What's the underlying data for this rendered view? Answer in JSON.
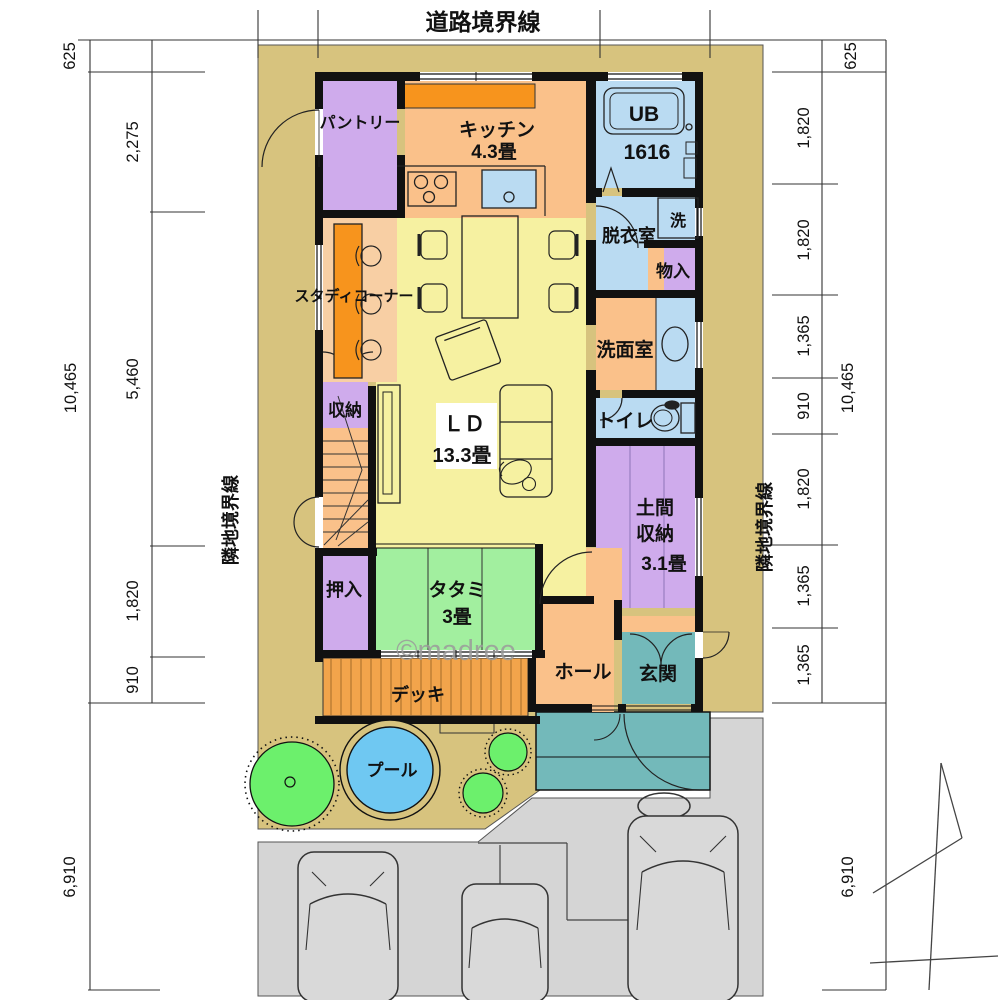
{
  "labels": {
    "road_boundary": "道路境界線",
    "neighbor_boundary_left": "隣地境界線",
    "neighbor_boundary_right": "隣地境界線",
    "watermark": "©madree"
  },
  "dims": {
    "left": {
      "outer": [
        "625",
        "10,465",
        "6,910"
      ],
      "inner": [
        "2,275",
        "5,460",
        "1,820",
        "910"
      ]
    },
    "right": {
      "outer": [
        "625",
        "10,465",
        "6,910"
      ],
      "inner": [
        "1,820",
        "1,820",
        "1,365",
        "910",
        "1,820",
        "1,365",
        "1,365"
      ]
    }
  },
  "rooms": {
    "pantry": "パントリー",
    "kitchen": "キッチン",
    "kitchen_size": "4.3畳",
    "unit_bath": "UB",
    "unit_bath_size": "1616",
    "washer": "洗",
    "dressing_room": "脱衣室",
    "closet_small": "物入",
    "washroom": "洗面室",
    "toilet": "トイレ",
    "study_corner": "スタディコーナー",
    "stair_storage": "収納",
    "living_dining": "ＬＤ",
    "living_dining_size": "13.3畳",
    "oshiire": "押入",
    "tatami": "タタミ",
    "tatami_size": "3畳",
    "doma_line1": "土間",
    "doma_line2": "収納",
    "doma_size": "3.1畳",
    "hall": "ホール",
    "entrance": "玄関",
    "deck": "デッキ",
    "pool": "プール"
  },
  "colors": {
    "site_tan": "#d7c37e",
    "room_orange": "#fac18a",
    "counter_orange": "#f7941d",
    "ld_yellow": "#f6f1a1",
    "purple": "#cfabec",
    "light_blue": "#badbf2",
    "tatami_green": "#a2ef9f",
    "entrance_teal": "#73b9ba",
    "pool_blue": "#6fc8f2",
    "tree_green": "#6cf06c",
    "driveway_gray": "#d5d5d5",
    "deck_orange": "#f2a44b",
    "study_peach": "#f8cfa4",
    "wall_black": "#111111"
  }
}
